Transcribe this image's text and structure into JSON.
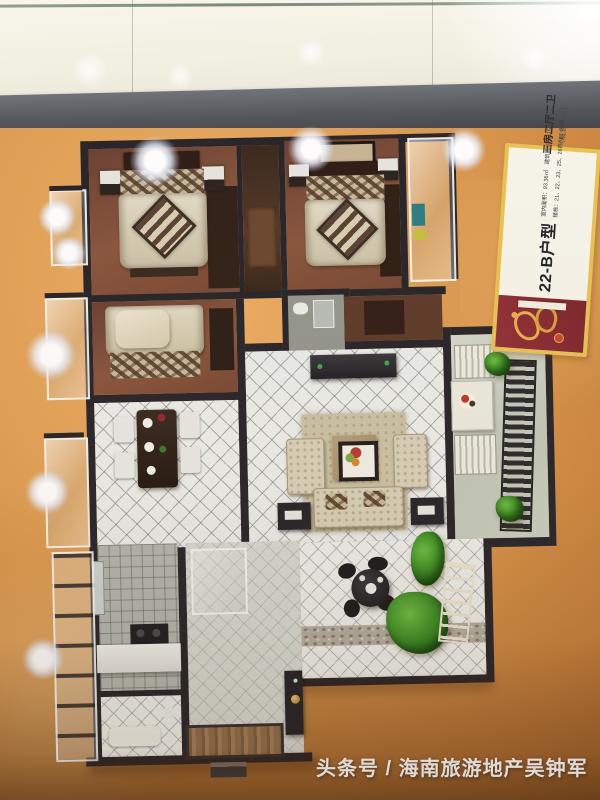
{
  "sign": {
    "title": "22-B户型",
    "subtitle": "三房二厅二卫",
    "subtitle_note": "（概念四房）",
    "details": [
      "室内面积：93.36㎡　建筑面积：115.70㎡",
      "楼栋：21、22、23、25、26栋02、06房"
    ]
  },
  "watermark": {
    "text": "头条号 / 海南旅游地产吴钟军"
  },
  "palette": {
    "board_orange": "#dd9a52",
    "wall_dark": "#28262c",
    "bedroom_floor": "#7a4a36",
    "tile_white": "#eceeea",
    "sign_border": "#e9c453",
    "sign_logo_red": "#8c2e36",
    "sign_logo_gold": "#e6b14d",
    "led_white": "#ffffff",
    "plant_green": "#3f9028"
  },
  "icons": {
    "developer_logo": "developer-logo-icon",
    "led_lights": "led-light-icon",
    "door_knob": "door-knob-icon"
  }
}
